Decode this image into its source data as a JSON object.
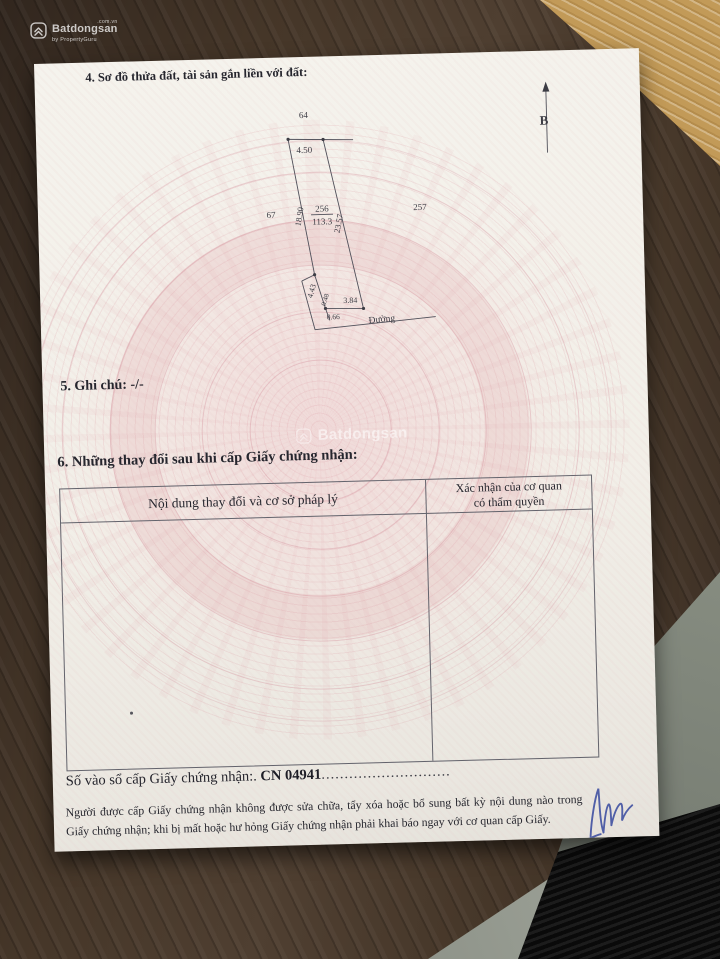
{
  "site_logo": {
    "brand": "Batdongsan",
    "domain": ".com.vn",
    "byline": "by PropertyGuru"
  },
  "center_watermark": {
    "brand": "Batdongsan"
  },
  "document": {
    "section4_title": "4. Sơ đồ thửa đất, tài sản gắn liền với đất:",
    "section5_title": "5. Ghi chú: -/-",
    "section6_title": "6. Những thay đổi sau khi cấp Giấy chứng nhận:",
    "table": {
      "col1_header": "Nội dung thay đổi và cơ sở pháp lý",
      "col2_header_line1": "Xác nhận của cơ quan",
      "col2_header_line2": "có thẩm quyền"
    },
    "serial_label": "Số vào sổ cấp Giấy chứng nhận:.",
    "serial_number": "CN 04941",
    "serial_dots": "............................",
    "footer_note": "Người được cấp Giấy chứng nhận không được sửa chữa, tẩy xóa hoặc bổ sung bất kỳ nội dung nào trong Giấy chứng nhận; khi bị mất hoặc hư hỏng Giấy chứng nhận phải khai báo ngay với cơ quan cấp Giấy."
  },
  "diagram": {
    "north_label": "B",
    "road_label": "Đường",
    "parcel_number": "256",
    "parcel_area": "113.3",
    "adjacent_top": "64",
    "adjacent_left": "67",
    "adjacent_right": "257",
    "dim_top": "4.50",
    "dim_left": "18.90",
    "dim_right": "23.57",
    "dim_lower_left": "4.43",
    "dim_small_a": "0.48",
    "dim_small_b": "0.66",
    "dim_bottom": "3.84"
  }
}
